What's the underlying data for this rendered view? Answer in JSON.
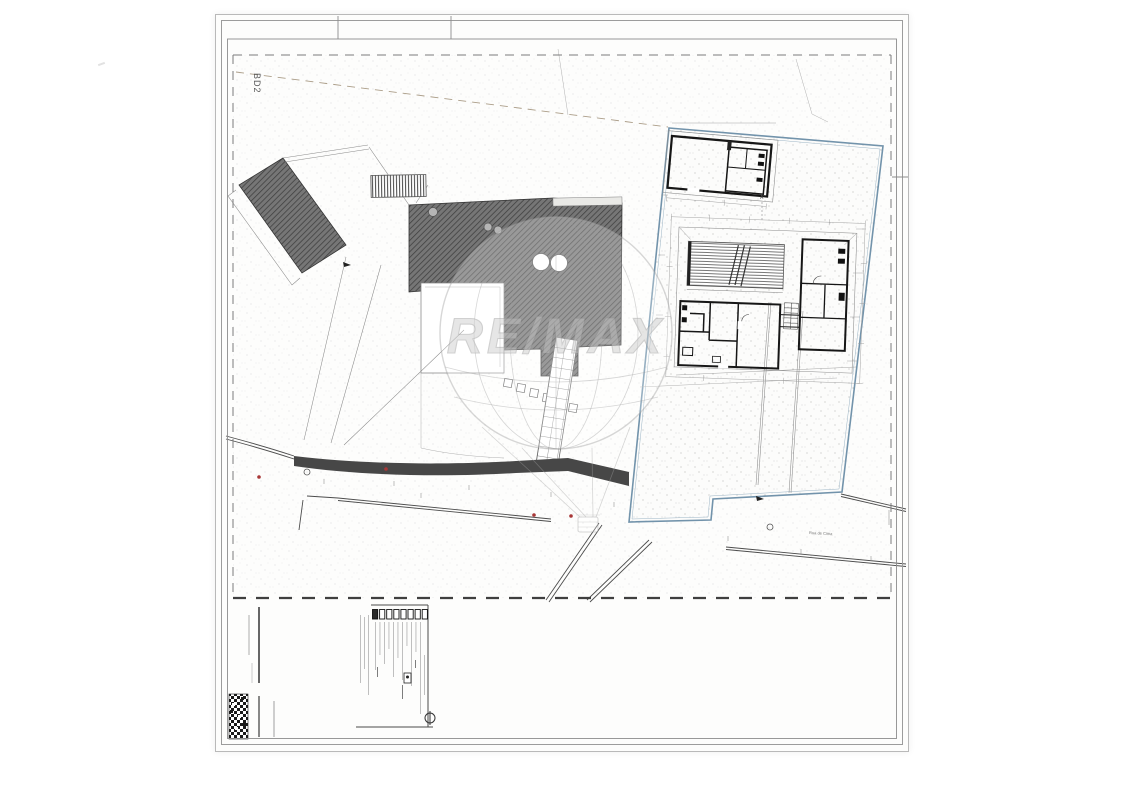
{
  "sheet": {
    "plan_area_label": "BD2",
    "section_marker": "A",
    "street_label": "Rua de Cima"
  },
  "watermark": {
    "brand_text": "RE/MAX"
  },
  "titleblock": {
    "stamp_box_count": 8
  },
  "colors": {
    "paper": "#fdfdfc",
    "ink": "#3a3a3a",
    "roof-fill": "#767676",
    "roof-line": "#3e3e3e",
    "parcel-blue": "#7293ab",
    "marker-red": "#a83737",
    "wall-band": "#474747",
    "watermark-gray": "#a2a2a2"
  }
}
